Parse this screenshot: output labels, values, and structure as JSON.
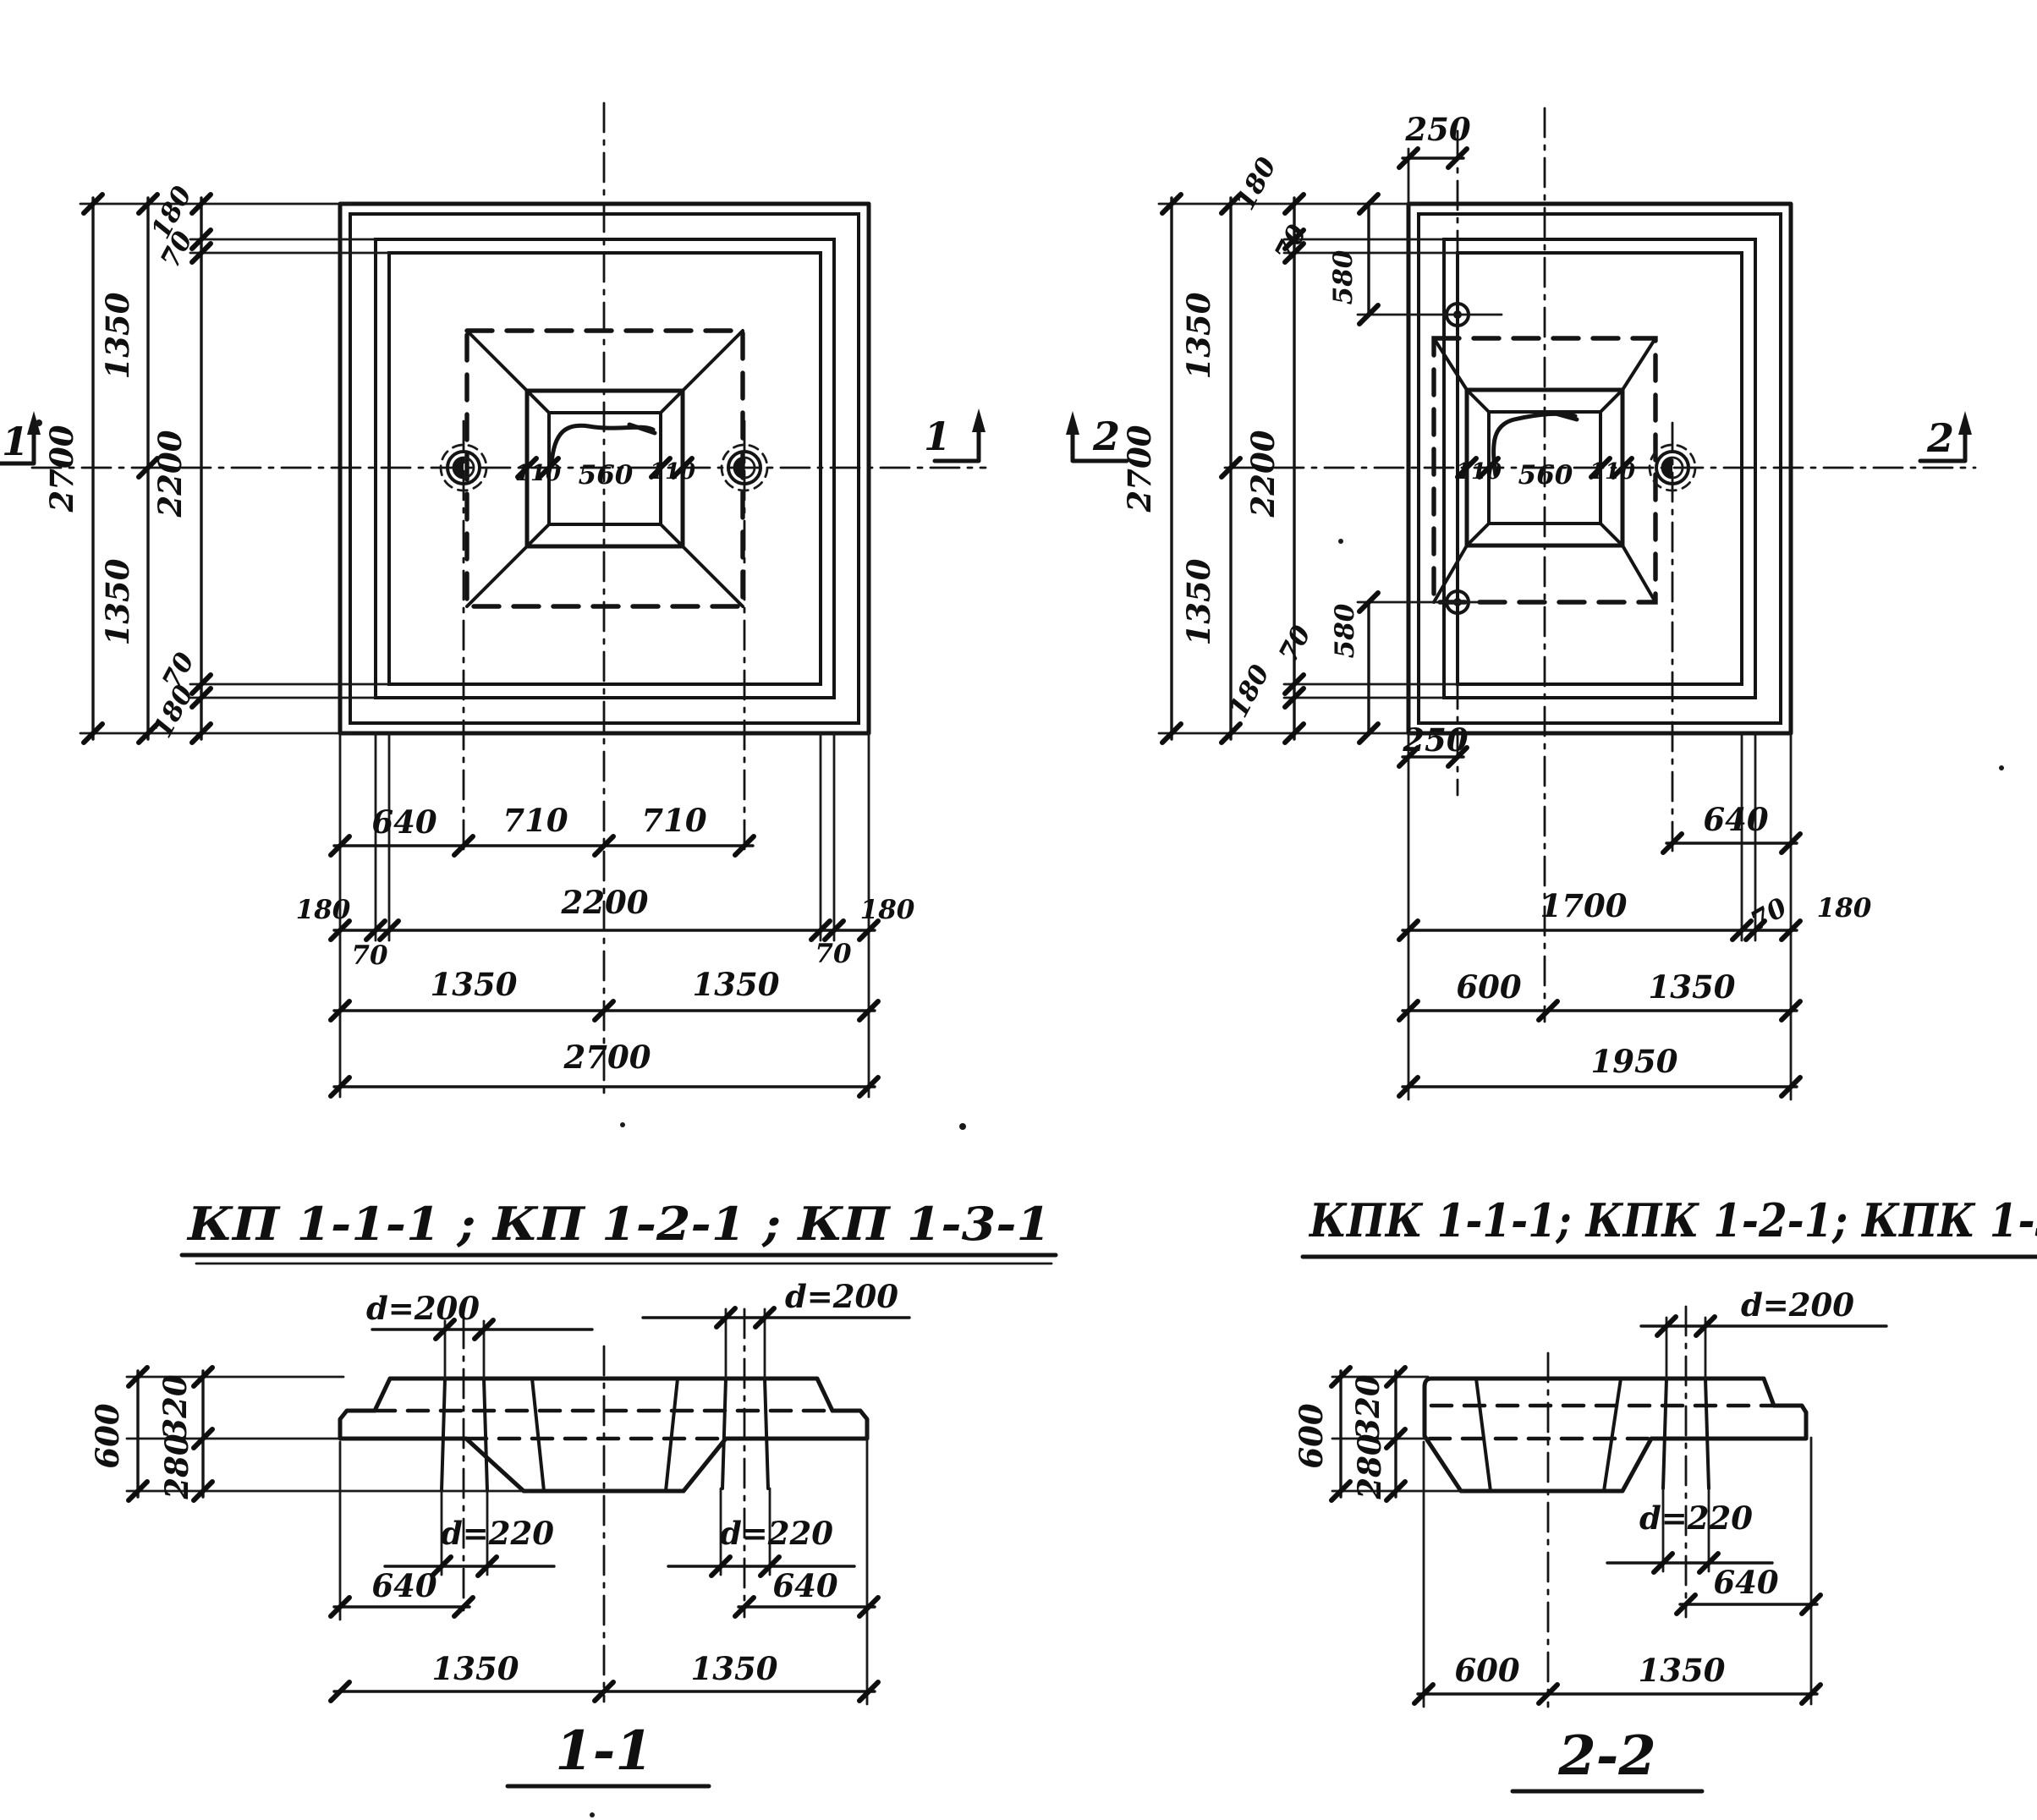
{
  "drawing": {
    "plan_left": {
      "marker": "1",
      "chain_left": {
        "total": "2700",
        "half_top": "1350",
        "half_bottom": "1350",
        "inner": "2200",
        "edge_top": "180",
        "chamfer_top": "70",
        "chamfer_bottom": "70",
        "edge_bottom": "180"
      },
      "socket": {
        "left": "110",
        "width": "560",
        "right": "110"
      },
      "row_sleeves": {
        "a": "640",
        "b": "710",
        "c": "710"
      },
      "row_inner": {
        "left": "180",
        "mid": "2200",
        "right": "180",
        "sub_left": "70",
        "sub_right": "70"
      },
      "row_halves": {
        "left": "1350",
        "right": "1350"
      },
      "row_total": "2700"
    },
    "plan_right": {
      "marker": "2",
      "top_offset": "250",
      "bottom_offset": "250",
      "chain_left": {
        "total": "2700",
        "half_top": "1350",
        "half_bottom": "1350",
        "inner": "2200",
        "edge_top": "180",
        "chamfer_top": "70",
        "bolt_top": "580",
        "bolt_bottom": "580",
        "chamfer_bottom": "70",
        "edge_bottom": "180"
      },
      "socket": {
        "left": "110",
        "width": "560",
        "right": "110"
      },
      "sleeve_offset": "640",
      "row_inner": {
        "main": "1700",
        "sub": "70",
        "edge": "180"
      },
      "row_halves": {
        "left": "600",
        "right": "1350"
      },
      "row_total": "1950"
    },
    "title_left": "КП 1-1-1 ; КП 1-2-1 ; КП 1-3-1",
    "title_right": "КПК 1-1-1; КПК 1-2-1; КПК 1-3-1",
    "section_left": {
      "title": "1-1",
      "d_top_left": "d=200",
      "d_top_right": "d=200",
      "d_bot_left": "d=220",
      "d_bot_right": "d=220",
      "height_total": "600",
      "height_top": "320",
      "height_bottom": "280",
      "off_left": "640",
      "off_right": "640",
      "half_left": "1350",
      "half_right": "1350"
    },
    "section_right": {
      "title": "2-2",
      "d_top": "d=200",
      "d_bot": "d=220",
      "height_total": "600",
      "height_top": "320",
      "height_bottom": "280",
      "off_right": "640",
      "seg_left": "600",
      "seg_right": "1350"
    }
  }
}
